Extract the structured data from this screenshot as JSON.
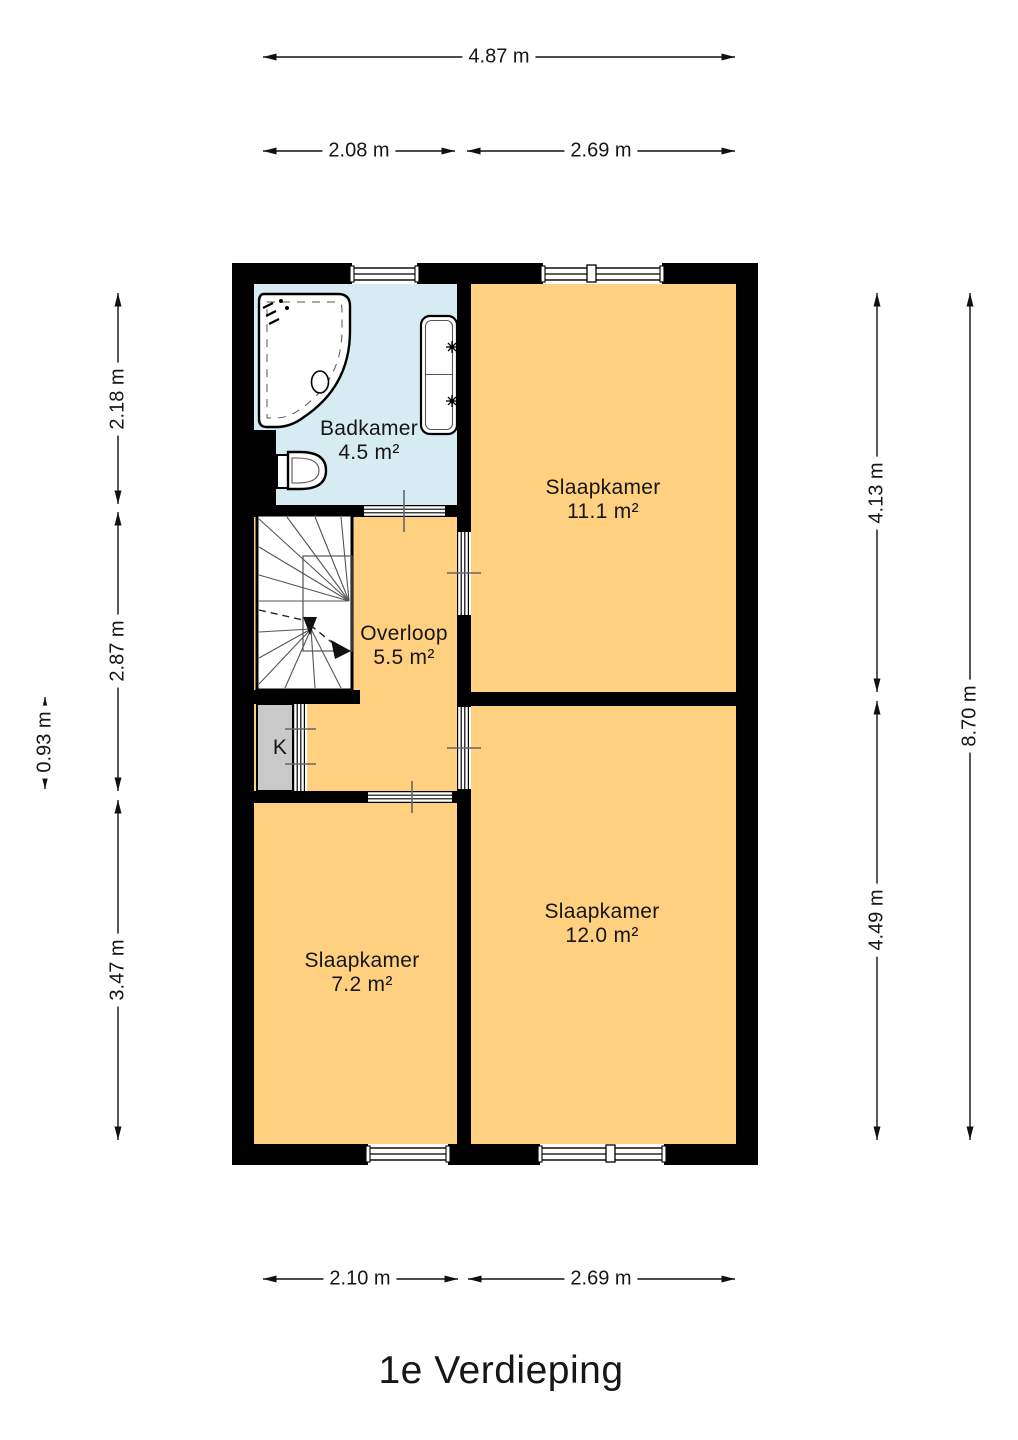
{
  "page": {
    "title": "1e Verdieping"
  },
  "floor_plan": {
    "rooms": [
      {
        "name": "Badkamer",
        "area": "4.5 m²"
      },
      {
        "name": "Slaapkamer",
        "area": "11.1 m²"
      },
      {
        "name": "Overloop",
        "area": "5.5 m²"
      },
      {
        "name": "Slaapkamer",
        "area": "12.0 m²"
      },
      {
        "name": "Slaapkamer",
        "area": "7.2 m²"
      },
      {
        "name": "K",
        "area": ""
      }
    ],
    "dimensions": {
      "top_total": "4.87 m",
      "top_left": "2.08 m",
      "top_right": "2.69 m",
      "left_upper": "2.18 m",
      "left_middle": "2.87 m",
      "left_closet": "0.93 m",
      "left_lower": "3.47 m",
      "right_upper": "4.13 m",
      "right_lower": "4.49 m",
      "right_total": "8.70 m",
      "bottom_left": "2.10 m",
      "bottom_right": "2.69 m"
    },
    "colors": {
      "wall": "#000000",
      "room_fill": "#FFD080",
      "bathroom_fill": "#D6EBF2",
      "closet_fill": "#C9C9C9"
    }
  }
}
